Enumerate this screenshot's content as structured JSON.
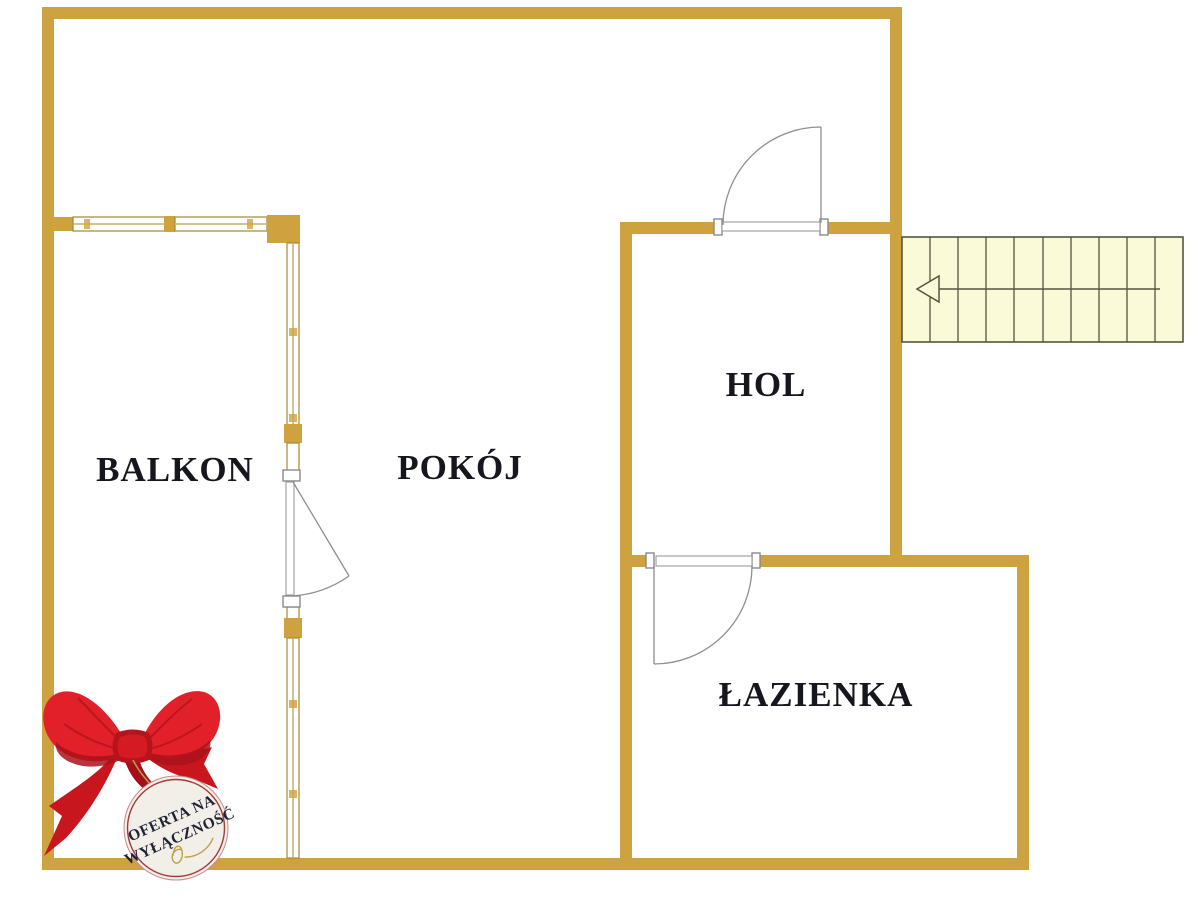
{
  "page": {
    "background": "#FFFFFF"
  },
  "floor_plan": {
    "rooms": [
      {
        "label": "BALKON"
      },
      {
        "label": "POKÓJ"
      },
      {
        "label": "HOL"
      },
      {
        "label": "ŁAZIENKA"
      }
    ],
    "stairs": {
      "treads": 10,
      "arrow_direction": "left"
    },
    "doors": [
      {
        "name": "entry-door",
        "location": "hol-top-wall",
        "swing": "into-upper-room"
      },
      {
        "name": "bathroom-door",
        "location": "bathroom-top-wall",
        "swing": "into-bathroom"
      },
      {
        "name": "balcony-door",
        "location": "balcony-right-wall",
        "swing": "into-pokoj"
      }
    ],
    "colors": {
      "wall": "#CFA240",
      "window_line": "#A5872F",
      "door_line": "#8F8F8F",
      "stairs_fill": "#FAFAD8",
      "stairs_line": "#55553E",
      "label_text": "#16161F"
    }
  },
  "badge": {
    "line1": "OFERTA NA",
    "line2": "WYŁĄCZNOŚĆ",
    "colors": {
      "ribbon": "#E2202A",
      "ribbon_dark": "#A8121A",
      "face": "#F2EFE8",
      "ring": "#A13B3B",
      "text": "#1E2233",
      "gold": "#BFA045"
    }
  }
}
